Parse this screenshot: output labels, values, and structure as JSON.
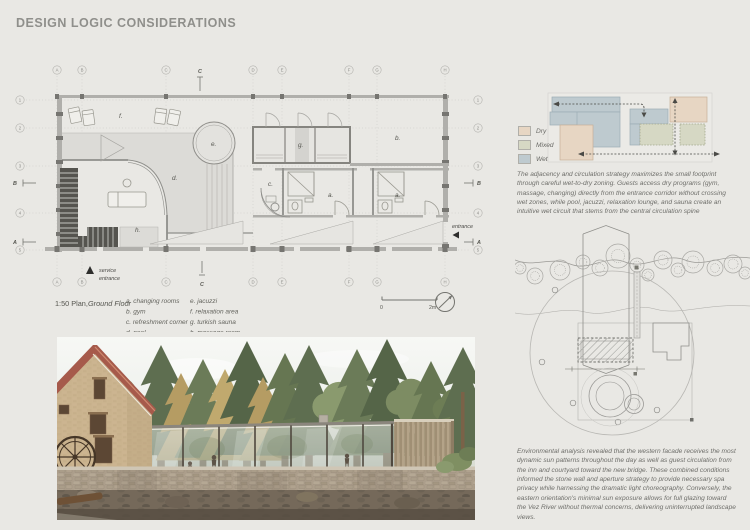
{
  "page": {
    "title": "DESIGN LOGIC CONSIDERATIONS"
  },
  "colors": {
    "background": "#e9e8e4",
    "dry": "#e7d6c3",
    "mixed": "#d6d8c4",
    "wet": "#becacf",
    "body_text": "#6e6e6a"
  },
  "plan": {
    "caption_prefix": "1:50 Plan,",
    "caption_title": "Ground Floor",
    "grid_cols": [
      "A",
      "B",
      "C",
      "D",
      "E",
      "F",
      "G",
      "H"
    ],
    "grid_rows": [
      "1",
      "2",
      "3",
      "4",
      "5"
    ],
    "sections": {
      "a": "A",
      "b": "B",
      "c": "C"
    },
    "rooms": {
      "a": "a.",
      "b": "b.",
      "c": "c.",
      "d": "d.",
      "e": "e.",
      "f": "f.",
      "g": "g.",
      "h": "h."
    },
    "legend_left": [
      "a. changing rooms",
      "b. gym",
      "c. refreshment corner",
      "d. pool"
    ],
    "legend_right": [
      "e. jacuzzi",
      "f. relaxation area",
      "g. turkish sauna",
      "h. massage room"
    ],
    "annotations": {
      "service_line1": "service",
      "service_line2": "entrance",
      "entrance": "entrance"
    },
    "scale": {
      "zero": "0",
      "two_m": "2m"
    }
  },
  "adjacency": {
    "legend": [
      {
        "label": "Dry",
        "color": "#e7d6c3"
      },
      {
        "label": "Mixed",
        "color": "#d6d8c4"
      },
      {
        "label": "Wet",
        "color": "#becacf"
      }
    ],
    "paragraph": "The adjacency and circulation strategy maximizes the small footprint through careful wet-to-dry zoning. Guests access dry programs (gym, massage, changing) directly from the entrance corridor without crossing wet zones, while pool, jacuzzi, relaxation lounge, and sauna create an intuitive wet circuit that stems from the central circulation spine"
  },
  "site": {
    "paragraph": "Environmental analysis revealed that the western facade receives the most dynamic sun patterns throughout the day as well as guest circulation from the inn and courtyard toward the new bridge. These combined conditions informed the stone wall and aperture strategy to provide necessary spa privacy while harnessing the dramatic light choreography. Conversely, the eastern orientation's minimal sun exposure allows for full glazing toward the Vez River without thermal concerns, delivering uninterrupted landscape views."
  }
}
